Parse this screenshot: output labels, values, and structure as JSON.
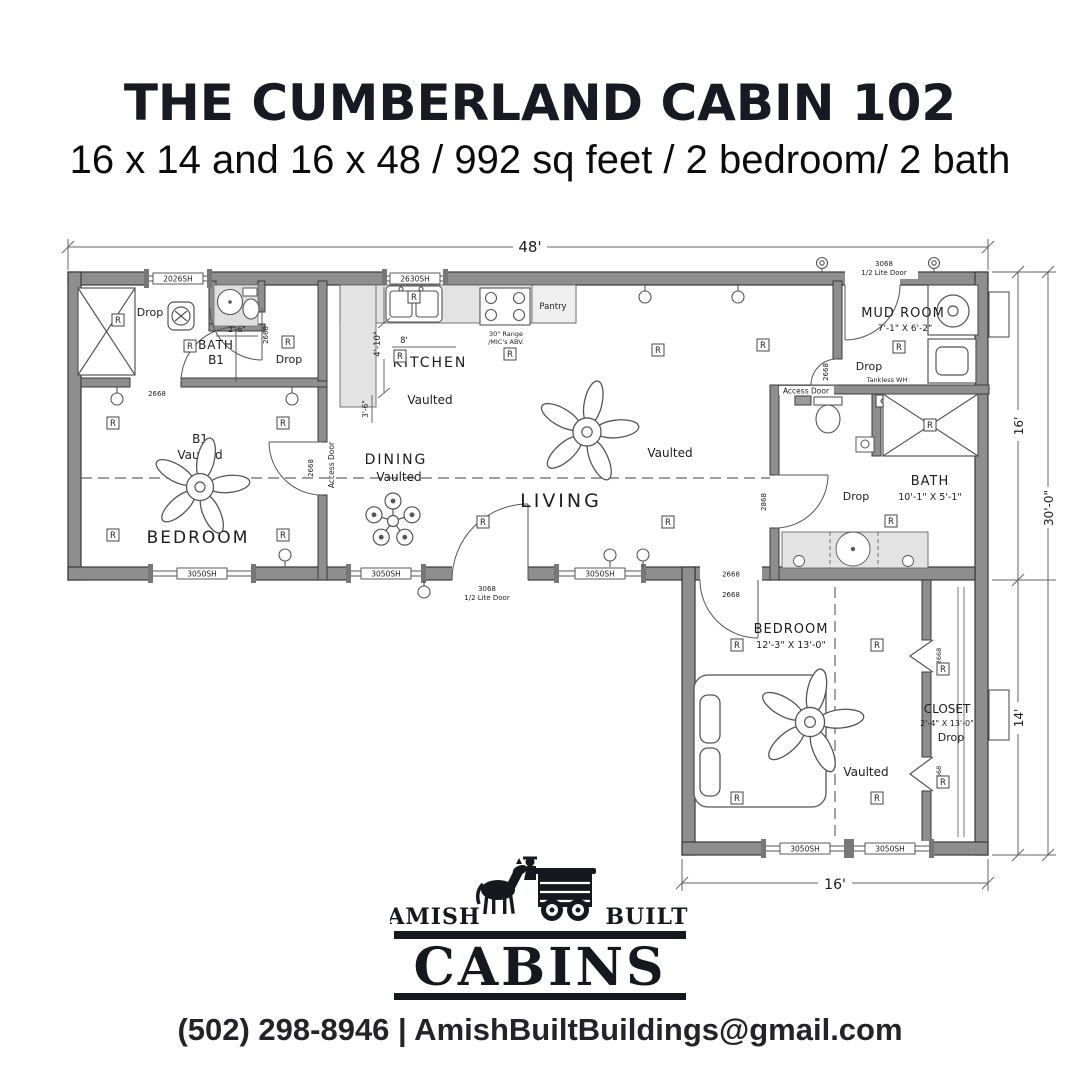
{
  "header": {
    "title": "THE CUMBERLAND CABIN 102",
    "subtitle": "16 x 14 and 16 x 48 / 992 sq feet / 2 bedroom/ 2 bath"
  },
  "floorplan": {
    "dims": {
      "w48": "48'",
      "h16": "16'",
      "h30": "30'-0\"",
      "h14": "14'",
      "w16": "16'",
      "k_depth": "4'-10\"",
      "k_run": "8'",
      "k_side": "3'-6\"",
      "b1_sink": "2'-6\""
    },
    "openings": {
      "w2026": "2026SH",
      "w2630": "2630SH",
      "w3050": "3050SH",
      "d2668": "2668",
      "d2868": "2868",
      "d3068": "3068",
      "lite": "1/2 Lite Door",
      "access": "Access Door",
      "recep": "R"
    },
    "rooms": {
      "bath_b1": {
        "name": "BATH",
        "unit": "B1",
        "drop": "Drop"
      },
      "bedroom_b1": {
        "unit": "B1",
        "ceiling": "Vaulted",
        "name": "BEDROOM"
      },
      "kitchen": {
        "name": "KITCHEN",
        "ceiling": "Vaulted",
        "pantry": "Pantry",
        "range1": "30\" Range",
        "range2": "/MIC's ABV."
      },
      "dining": {
        "name": "DINING",
        "ceiling": "Vaulted"
      },
      "living": {
        "name": "LIVING",
        "ceiling": "Vaulted"
      },
      "mud_room": {
        "name": "MUD ROOM",
        "size": "7'-1\" X 6'-2\"",
        "drop": "Drop",
        "tankless": "Tankless WH"
      },
      "bath_main": {
        "name": "BATH",
        "size": "10'-1\" X 5'-1\"",
        "drop": "Drop"
      },
      "bedroom_main": {
        "name": "BEDROOM",
        "size": "12'-3\" X 13'-0\"",
        "ceiling": "Vaulted"
      },
      "closet": {
        "name": "CLOSET",
        "size": "2'-4\" X 13'-0\"",
        "drop": "Drop"
      }
    }
  },
  "logo": {
    "amish": "AMISH",
    "built": "BUILT",
    "cabins": "CABINS"
  },
  "footer": {
    "contact": "(502) 298-8946 | AmishBuiltBuildings@gmail.com"
  }
}
